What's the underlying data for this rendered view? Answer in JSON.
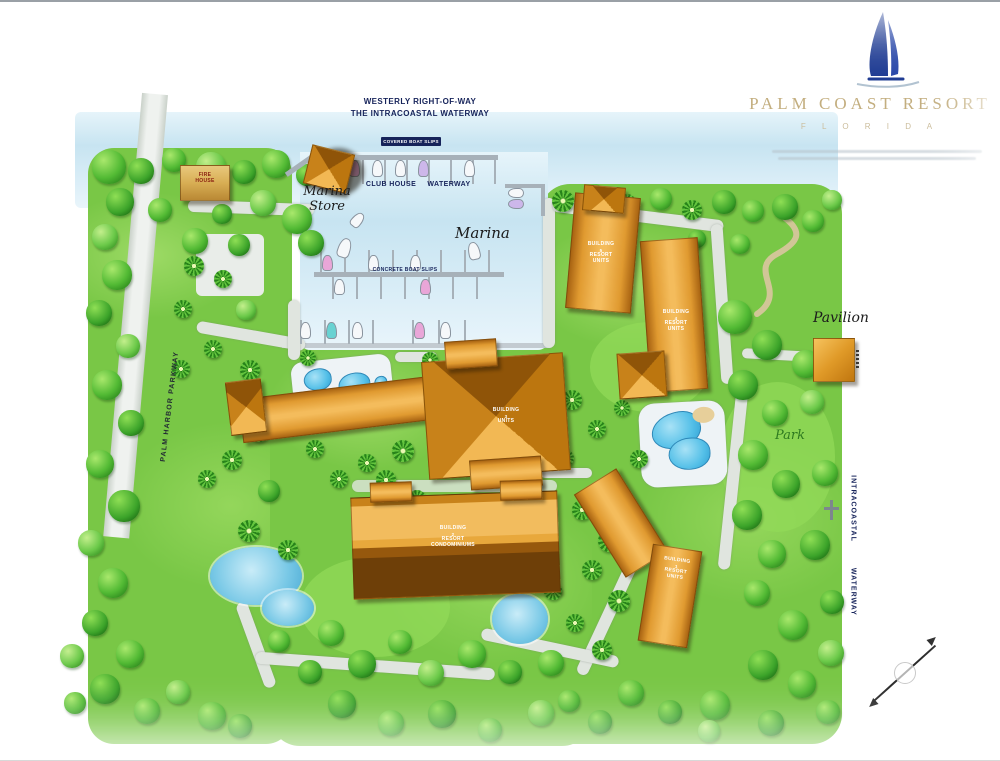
{
  "logo": {
    "brand": "PALM COAST RESORT",
    "tagline": "F L O R I D A",
    "boat_color": "#1d3a92",
    "text_color": "#c3ae7f"
  },
  "header": {
    "line1": "WESTERLY RIGHT-OF-WAY",
    "line2": "THE INTRACOASTAL WATERWAY"
  },
  "marina": {
    "store_line1": "Marina",
    "store_line2": "Store",
    "club_house": "CLUB HOUSE",
    "waterway": "WATERWAY",
    "marina_script": "Marina",
    "covered_slips": "COVERED BOAT SLIPS",
    "concrete_slips": "CONCRETE BOAT SLIPS"
  },
  "roads": {
    "palm_harbor_parkway": "PALM HARBOR PARKWAY"
  },
  "waterway_label": {
    "line1": "INTRACOASTAL",
    "line2": "WATERWAY"
  },
  "labels": {
    "pavilion": "Pavilion",
    "park": "Park",
    "fire_line1": "FIRE",
    "fire_line2": "HOUSE"
  },
  "buildings": {
    "north": {
      "lines": [
        "BUILDING",
        "5",
        "RESORT",
        "UNITS"
      ]
    },
    "east": {
      "lines": [
        "BUILDING",
        "4",
        "RESORT",
        "UNITS"
      ]
    },
    "central": {
      "lines": [
        "BUILDING",
        "3",
        "UNITS"
      ]
    },
    "south": {
      "lines": [
        "BUILDING",
        "2",
        "RESORT",
        "CONDOMINIUMS"
      ]
    },
    "southeast": {
      "lines": [
        "BUILDING",
        "1",
        "RESORT",
        "UNITS"
      ]
    }
  },
  "colors": {
    "water": "#c7e4f1",
    "grass": "#79c746",
    "roof": "#e09a30",
    "navy_text": "#16235a"
  }
}
